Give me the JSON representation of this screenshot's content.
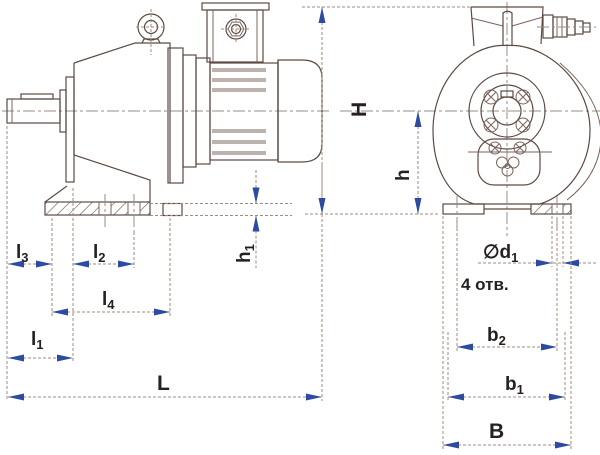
{
  "drawing": {
    "description_labels": {
      "l1": {
        "base": "l",
        "sub": "1"
      },
      "l2": {
        "base": "l",
        "sub": "2"
      },
      "l3": {
        "base": "l",
        "sub": "3"
      },
      "l4": {
        "base": "l",
        "sub": "4"
      },
      "L": {
        "base": "L",
        "sub": ""
      },
      "h1": {
        "base": "h",
        "sub": "1"
      },
      "H": {
        "base": "H",
        "sub": ""
      },
      "h": {
        "base": "h",
        "sub": ""
      },
      "b2": {
        "base": "b",
        "sub": "2"
      },
      "b1": {
        "base": "b",
        "sub": "1"
      },
      "B": {
        "base": "B",
        "sub": ""
      },
      "d1": {
        "base": "∅d",
        "sub": "1"
      },
      "holes_note": "4 отв."
    },
    "colors": {
      "background": "#ffffff",
      "outline": "#5c4a42",
      "dimension_lines": "#a18a7e",
      "arrowheads": "#2c4ba1",
      "labels": "#262020"
    }
  }
}
